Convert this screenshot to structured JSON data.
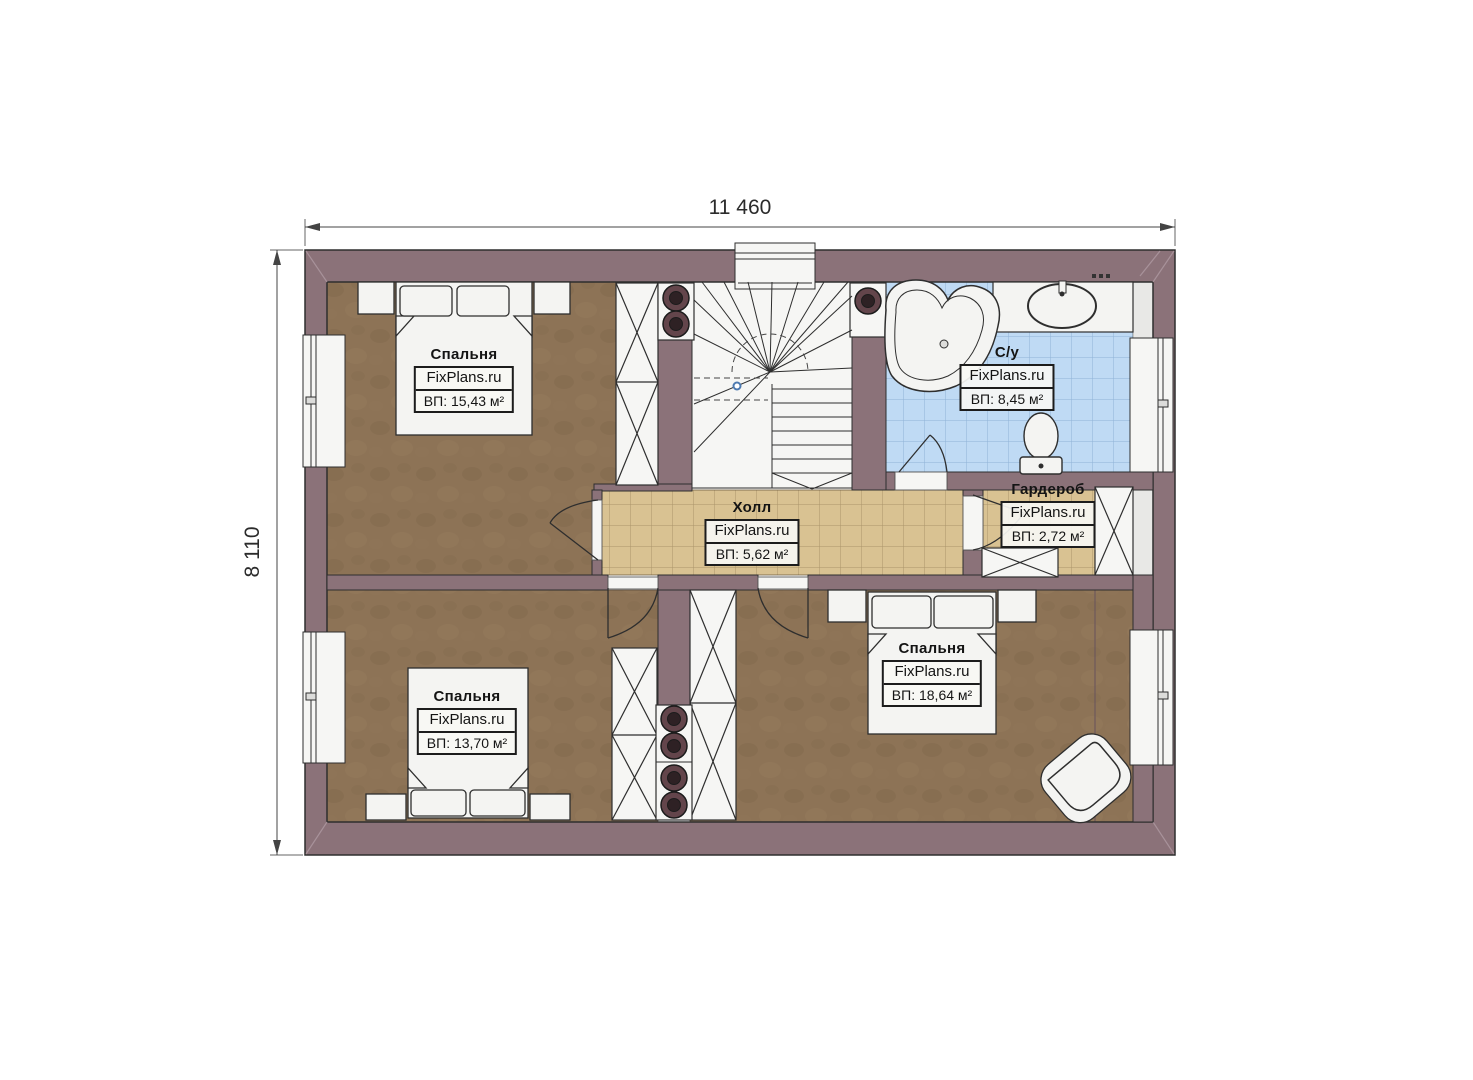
{
  "plan": {
    "dimensions": {
      "width_label": "11 460",
      "height_label": "8 110"
    },
    "rooms": [
      {
        "id": "bedroom-top-left",
        "name": "Спальня",
        "brand": "FixPlans.ru",
        "area": "ВП: 15,43 м²"
      },
      {
        "id": "bathroom",
        "name": "С/у",
        "brand": "FixPlans.ru",
        "area": "ВП: 8,45 м²"
      },
      {
        "id": "hall",
        "name": "Холл",
        "brand": "FixPlans.ru",
        "area": "ВП: 5,62 м²"
      },
      {
        "id": "wardrobe",
        "name": "Гардероб",
        "brand": "FixPlans.ru",
        "area": "ВП: 2,72 м²"
      },
      {
        "id": "bedroom-bottom-left",
        "name": "Спальня",
        "brand": "FixPlans.ru",
        "area": "ВП: 13,70 м²"
      },
      {
        "id": "bedroom-bottom-right",
        "name": "Спальня",
        "brand": "FixPlans.ru",
        "area": "ВП: 18,64 м²"
      }
    ],
    "colors": {
      "wall": "#8b7279",
      "bedroom_floor": "#8d7356",
      "hall_floor": "#d9c292",
      "bath_floor": "#bfdaf4",
      "fixture": "#f4f4f2"
    }
  }
}
